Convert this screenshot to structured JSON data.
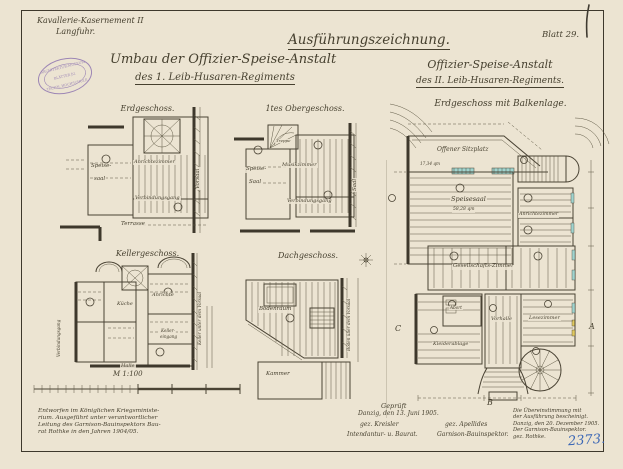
{
  "sheet": {
    "blatt_label": "Blatt 29.",
    "inventory_number": "2373.",
    "colors": {
      "paper": "#ece4d2",
      "ink": "#46402f",
      "stamp_purple": "#8a6fae",
      "blue_ink": "#3a66b5",
      "window_teal": "#9fd4cf",
      "window_yellow": "#e0c95f"
    }
  },
  "header": {
    "location_line1": "Kavallerie-Kasernement II",
    "location_line2": "Langfuhr.",
    "title_left_line1": "Umbau der Offizier-Speise-Anstalt",
    "title_left_line2": "des 1. Leib-Husaren-Regiments",
    "title_right_top": "Ausführungszeichnung.",
    "title_right_line1": "Offizier-Speise-Anstalt",
    "title_right_line2": "des II. Leib-Husaren-Regiments."
  },
  "stamp": {
    "line1": "ARCHITEKTUR-MUSEUM",
    "line2": "BLÄTTER JG.",
    "line3": "TECHN. HOCHSCHULE"
  },
  "plans": {
    "erdgeschoss": {
      "title": "Erdgeschoss.",
      "rooms": {
        "speisesaal_line1": "Speise-",
        "speisesaal_line2": "saal",
        "anrichtezimmer": "Anrichtezimmer",
        "verbindungsgang": "Verbindungsgang",
        "terrasse": "Terrasse",
        "vorsaal": "Vorsaal"
      }
    },
    "obergeschoss": {
      "title": "1tes Obergeschoss.",
      "rooms": {
        "treppe": "Treppe",
        "speisesaal_line1": "Speise-",
        "speisesaal_line2": "Saal",
        "musikzimmer": "Musikzimmer",
        "verbindungsgang": "Verbindungsgang",
        "saal": "Saal"
      }
    },
    "kellergeschoss": {
      "title": "Kellergeschoss.",
      "scale_label": "M 1:100",
      "rooms": {
        "kueche": "Küche",
        "anrichte": "Anrichte",
        "kellereingang_line1": "Keller-",
        "kellereingang_line2": "eingang",
        "halle": "Halle",
        "verbindungsgang": "Verbindungsgang",
        "keller_unter_vorsaal": "Keller unter dem Vorsaal"
      }
    },
    "dachgeschoss": {
      "title": "Dachgeschoss.",
      "rooms": {
        "bodenraum": "Bodenraum",
        "kammer": "Kammer",
        "boden_ueber_vorsaal": "Boden über dem Vorsaal"
      }
    },
    "balkenlage": {
      "title": "Erdgeschoss mit Balkenlage.",
      "rooms": {
        "offener_sitzplatz": "Offener Sitzplatz",
        "sitzplatz_area": "17,34 qm",
        "speisesaal": "Speisesaal",
        "speisesaal_area": "58,28 qm",
        "anrichtezimmer": "Anrichtezimmer",
        "gesellschaftszimmer": "Gesellschafts-Zimmer",
        "abort": "Abort",
        "vorhalle": "Vorhalle",
        "lesezimmer": "Lesezimmer",
        "kleiderablage": "Kleiderablage"
      },
      "sections": {
        "a": "A",
        "b": "B",
        "c": "C"
      }
    }
  },
  "footer": {
    "note_left_line1": "Entworfen im Königlichen Kriegsministe-",
    "note_left_line2": "rium. Ausgeführt unter verantwortlicher",
    "note_left_line3": "Leitung des Garnison-Bauinspektors Bau-",
    "note_left_line4": "rat Rothke in den Jahren 1904/05.",
    "approval": {
      "geprueft": "Geprüft",
      "date": "Danzig, den 13. Juni 1905.",
      "sig_left": "gez. Kreisler",
      "sig_right": "gez. Apellides",
      "title_left": "Intendantur- u. Baurat.",
      "title_right": "Garnison-Bauinspektor."
    },
    "cert_line1": "Die Übereinstimmung mit",
    "cert_line2": "der Ausführung bescheinigt.",
    "cert_line3": "Danzig, den 20. Dezember 1905.",
    "cert_line4": "Der Garnison-Bauinspektor.",
    "cert_line5": "gez. Rothke."
  }
}
